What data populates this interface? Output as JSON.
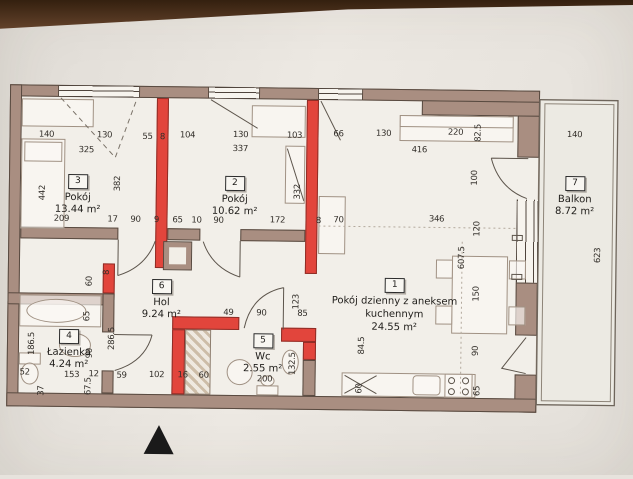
{
  "palette": {
    "wall_brown": "#a98e81",
    "wall_red": "#e2453c",
    "paper": "#e7e3dd",
    "room_fill": "#f2efe9",
    "wood": "#4a2f1c",
    "line": "#5c544b"
  },
  "rooms": [
    {
      "number": "1",
      "name": "Pokój dzienny z aneksem kuchennym",
      "area": "24.55 m²",
      "x": 395,
      "y": 277
    },
    {
      "number": "2",
      "name": "Pokój",
      "area": "10.62 m²",
      "x": 234,
      "y": 177
    },
    {
      "number": "3",
      "name": "Pokój",
      "area": "13.44 m²",
      "x": 77,
      "y": 177
    },
    {
      "number": "4",
      "name": "Łazienka",
      "area": "4.24 m²",
      "x": 70,
      "y": 332
    },
    {
      "number": "5",
      "name": "Wc",
      "area": "2.55 m²",
      "x": 264,
      "y": 334
    },
    {
      "number": "6",
      "name": "Hol",
      "area": "9.24 m²",
      "x": 162,
      "y": 281
    },
    {
      "number": "7",
      "name": "Balkon",
      "area": "8.72 m²",
      "x": 574,
      "y": 173
    }
  ],
  "dimensions": [
    {
      "t": "140",
      "x": 45,
      "y": 138
    },
    {
      "t": "130",
      "x": 103,
      "y": 138
    },
    {
      "t": "55",
      "x": 146,
      "y": 139
    },
    {
      "t": "8",
      "x": 161,
      "y": 139
    },
    {
      "t": "325",
      "x": 85,
      "y": 153
    },
    {
      "t": "104",
      "x": 186,
      "y": 137
    },
    {
      "t": "130",
      "x": 239,
      "y": 136
    },
    {
      "t": "103",
      "x": 293,
      "y": 136
    },
    {
      "t": "337",
      "x": 239,
      "y": 150
    },
    {
      "t": "66",
      "x": 337,
      "y": 134
    },
    {
      "t": "130",
      "x": 382,
      "y": 133
    },
    {
      "t": "220",
      "x": 454,
      "y": 131
    },
    {
      "t": "82.5",
      "x": 477,
      "y": 131,
      "v": 1
    },
    {
      "t": "416",
      "x": 418,
      "y": 149
    },
    {
      "t": "140",
      "x": 573,
      "y": 132
    },
    {
      "t": "442",
      "x": 42,
      "y": 196,
      "v": 1
    },
    {
      "t": "382",
      "x": 117,
      "y": 186,
      "v": 1
    },
    {
      "t": "332",
      "x": 297,
      "y": 192,
      "v": 1
    },
    {
      "t": "209",
      "x": 61,
      "y": 222
    },
    {
      "t": "17",
      "x": 112,
      "y": 222
    },
    {
      "t": "90",
      "x": 135,
      "y": 222
    },
    {
      "t": "9",
      "x": 156,
      "y": 222
    },
    {
      "t": "65",
      "x": 177,
      "y": 222
    },
    {
      "t": "10",
      "x": 196,
      "y": 222
    },
    {
      "t": "90",
      "x": 218,
      "y": 222
    },
    {
      "t": "172",
      "x": 277,
      "y": 221
    },
    {
      "t": "8",
      "x": 318,
      "y": 221
    },
    {
      "t": "70",
      "x": 338,
      "y": 220
    },
    {
      "t": "346",
      "x": 436,
      "y": 218
    },
    {
      "t": "100",
      "x": 474,
      "y": 176,
      "v": 1
    },
    {
      "t": "120",
      "x": 477,
      "y": 227,
      "v": 1
    },
    {
      "t": "607.5",
      "x": 462,
      "y": 256,
      "v": 1
    },
    {
      "t": "150",
      "x": 477,
      "y": 292,
      "v": 1
    },
    {
      "t": "90",
      "x": 477,
      "y": 349,
      "v": 1
    },
    {
      "t": "623",
      "x": 598,
      "y": 252,
      "v": 1
    },
    {
      "t": "60",
      "x": 90,
      "y": 284,
      "v": 1
    },
    {
      "t": "8",
      "x": 107,
      "y": 275,
      "v": 1
    },
    {
      "t": "65",
      "x": 88,
      "y": 319,
      "v": 1
    },
    {
      "t": "90",
      "x": 91,
      "y": 356,
      "v": 1
    },
    {
      "t": "286.5",
      "x": 113,
      "y": 341,
      "v": 1
    },
    {
      "t": "186.5",
      "x": 33,
      "y": 347,
      "v": 1
    },
    {
      "t": "67.5",
      "x": 90,
      "y": 389,
      "v": 1
    },
    {
      "t": "37",
      "x": 43,
      "y": 394,
      "v": 1
    },
    {
      "t": "52",
      "x": 26,
      "y": 376
    },
    {
      "t": "153",
      "x": 73,
      "y": 378
    },
    {
      "t": "12",
      "x": 95,
      "y": 377
    },
    {
      "t": "59",
      "x": 123,
      "y": 378
    },
    {
      "t": "102",
      "x": 158,
      "y": 377
    },
    {
      "t": "16",
      "x": 184,
      "y": 377
    },
    {
      "t": "60",
      "x": 205,
      "y": 377
    },
    {
      "t": "200",
      "x": 266,
      "y": 380
    },
    {
      "t": "49",
      "x": 229,
      "y": 314
    },
    {
      "t": "90",
      "x": 262,
      "y": 314
    },
    {
      "t": "85",
      "x": 303,
      "y": 314
    },
    {
      "t": "123",
      "x": 297,
      "y": 302,
      "v": 1
    },
    {
      "t": "132.5",
      "x": 294,
      "y": 364,
      "v": 1
    },
    {
      "t": "84.5",
      "x": 363,
      "y": 345,
      "v": 1
    },
    {
      "t": "60",
      "x": 361,
      "y": 388,
      "v": 1
    },
    {
      "t": "65",
      "x": 479,
      "y": 389,
      "v": 1
    }
  ]
}
